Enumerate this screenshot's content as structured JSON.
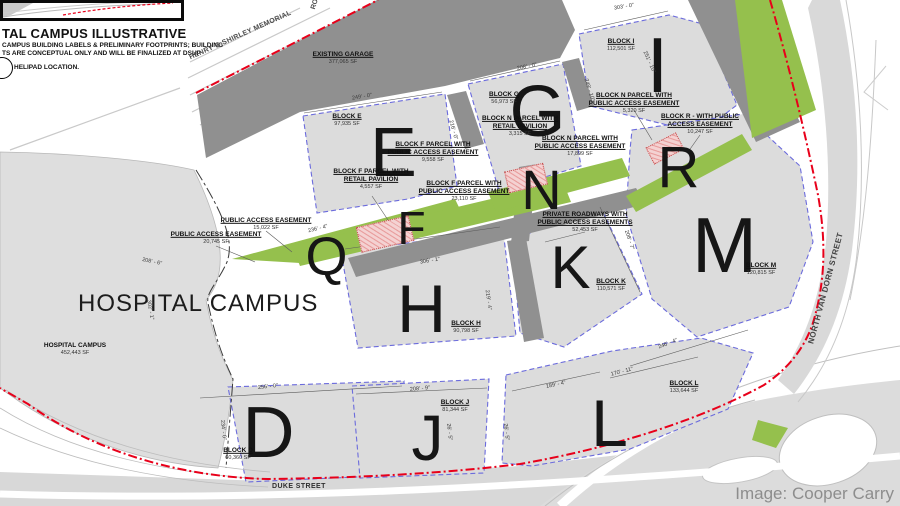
{
  "title_block": {
    "title": "TAL CAMPUS ILLUSTRATIVE",
    "note_line1": "CAMPUS BUILDING LABELS & PRELIMINARY FOOTPRINTS; BUILDING",
    "note_line2": "TS ARE CONCEPTUAL ONLY AND WILL BE FINALIZED AT DSUP",
    "helipad_label": "HELIPAD LOCATION."
  },
  "streets": {
    "duke": "DUKE STREET",
    "van_dorn": "NORTH VAN DORN STREET",
    "shirley": "HENRY G.SHIRLEY MEMORIAL",
    "road": "ROAD"
  },
  "campus": {
    "big_label": "HOSPITAL CAMPUS"
  },
  "credit": "Image: Cooper Carry",
  "letters": [
    {
      "ch": "E",
      "x": 393,
      "y": 152,
      "size": 70
    },
    {
      "ch": "F",
      "x": 411,
      "y": 228,
      "size": 46
    },
    {
      "ch": "G",
      "x": 537,
      "y": 112,
      "size": 72
    },
    {
      "ch": "N",
      "x": 541,
      "y": 190,
      "size": 56
    },
    {
      "ch": "I",
      "x": 657,
      "y": 65,
      "size": 78
    },
    {
      "ch": "R",
      "x": 678,
      "y": 168,
      "size": 58
    },
    {
      "ch": "M",
      "x": 724,
      "y": 245,
      "size": 78
    },
    {
      "ch": "Q",
      "x": 326,
      "y": 257,
      "size": 54
    },
    {
      "ch": "K",
      "x": 570,
      "y": 268,
      "size": 60
    },
    {
      "ch": "H",
      "x": 421,
      "y": 309,
      "size": 68
    },
    {
      "ch": "D",
      "x": 268,
      "y": 433,
      "size": 72
    },
    {
      "ch": "J",
      "x": 427,
      "y": 438,
      "size": 64
    },
    {
      "ch": "L",
      "x": 609,
      "y": 423,
      "size": 66
    }
  ],
  "parcel_labels": [
    {
      "lines": [
        "EXISTING GARAGE"
      ],
      "sf": "377,065 SF",
      "x": 343,
      "y": 58
    },
    {
      "lines": [
        "BLOCK E"
      ],
      "sf": "97,935 SF",
      "x": 347,
      "y": 120
    },
    {
      "lines": [
        "BLOCK G"
      ],
      "sf": "56,973 SF",
      "x": 504,
      "y": 98
    },
    {
      "lines": [
        "BLOCK I"
      ],
      "sf": "112,501 SF",
      "x": 621,
      "y": 45
    },
    {
      "lines": [
        "BLOCK N PARCEL WITH",
        "RETAIL PAVILION"
      ],
      "sf": "3,315 SF",
      "x": 520,
      "y": 126
    },
    {
      "lines": [
        "BLOCK N PARCEL WITH",
        "PUBLIC ACCESS EASEMENT"
      ],
      "sf": "17,899 SF",
      "x": 580,
      "y": 146
    },
    {
      "lines": [
        "BLOCK N PARCEL WITH",
        "PUBLIC ACCESS EASEMENT"
      ],
      "sf": "5,320 SF",
      "x": 634,
      "y": 103
    },
    {
      "lines": [
        "BLOCK R -  WITH PUBLIC",
        "ACCESS EASEMENT"
      ],
      "sf": "10,247 SF",
      "x": 700,
      "y": 124
    },
    {
      "lines": [
        "BLOCK F PARCEL WITH",
        "PUBLIC ACCESS EASEMENT"
      ],
      "sf": "9,558 SF",
      "x": 433,
      "y": 152
    },
    {
      "lines": [
        "BLOCK F PARCEL WITH",
        "RETAIL PAVILION"
      ],
      "sf": "4,557 SF",
      "x": 371,
      "y": 179
    },
    {
      "lines": [
        "BLOCK F PARCEL WITH",
        "PUBLIC ACCESS EASEMENT"
      ],
      "sf": "23,110 SF",
      "x": 464,
      "y": 191
    },
    {
      "lines": [
        "PUBLIC ACCESS EASEMENT"
      ],
      "sf": "15,022 SF",
      "x": 266,
      "y": 224
    },
    {
      "lines": [
        "PUBLIC ACCESS EASEMENT"
      ],
      "sf": "20,745 SF",
      "x": 216,
      "y": 238
    },
    {
      "lines": [
        "PRIVATE ROADWAYS WITH",
        "PUBLIC ACCESS EASEMENTS"
      ],
      "sf": "52,453 SF",
      "x": 585,
      "y": 222
    },
    {
      "lines": [
        "BLOCK K"
      ],
      "sf": "110,571 SF",
      "x": 611,
      "y": 285
    },
    {
      "lines": [
        "BLOCK M"
      ],
      "sf": "120,815 SF",
      "x": 761,
      "y": 269
    },
    {
      "lines": [
        "BLOCK H"
      ],
      "sf": "90,798 SF",
      "x": 466,
      "y": 327
    },
    {
      "lines": [
        "HOSPITAL CAMPUS"
      ],
      "sf": "452,443 SF",
      "x": 75,
      "y": 349,
      "plain": true
    },
    {
      "lines": [
        "BLOCK D"
      ],
      "sf": "60,360 SF",
      "x": 238,
      "y": 454
    },
    {
      "lines": [
        "BLOCK J"
      ],
      "sf": "81,344 SF",
      "x": 455,
      "y": 406
    },
    {
      "lines": [
        "BLOCK L"
      ],
      "sf": "133,644 SF",
      "x": 684,
      "y": 387
    }
  ],
  "dimensions": [
    {
      "text": "249' - 0\"",
      "x": 362,
      "y": 97,
      "rot": -9
    },
    {
      "text": "208' - 0\"",
      "x": 527,
      "y": 67,
      "rot": -11
    },
    {
      "text": "303' - 0\"",
      "x": 624,
      "y": 7,
      "rot": -9
    },
    {
      "text": "216' - 0\"",
      "x": 453,
      "y": 130,
      "rot": 75
    },
    {
      "text": "249' - 10\"",
      "x": 589,
      "y": 90,
      "rot": 72
    },
    {
      "text": "251' - 10\"",
      "x": 649,
      "y": 62,
      "rot": 66
    },
    {
      "text": "236' - 4\"",
      "x": 318,
      "y": 229,
      "rot": -14
    },
    {
      "text": "306' - 1\"",
      "x": 430,
      "y": 261,
      "rot": -9
    },
    {
      "text": "219' - 4\"",
      "x": 488,
      "y": 300,
      "rot": 82
    },
    {
      "text": "208' - 7\"",
      "x": 629,
      "y": 240,
      "rot": 72
    },
    {
      "text": "246' - 4\"",
      "x": 668,
      "y": 344,
      "rot": -21
    },
    {
      "text": "256' - 0\"",
      "x": 268,
      "y": 387,
      "rot": -6
    },
    {
      "text": "234' - 0\"",
      "x": 223,
      "y": 430,
      "rot": 84
    },
    {
      "text": "208' - 9\"",
      "x": 420,
      "y": 389,
      "rot": -5
    },
    {
      "text": "189' - 4\"",
      "x": 556,
      "y": 385,
      "rot": -12
    },
    {
      "text": "170' - 11\"",
      "x": 622,
      "y": 372,
      "rot": -14
    },
    {
      "text": "302' - 1\"",
      "x": 150,
      "y": 310,
      "rot": 80
    },
    {
      "text": "208' - 6\"",
      "x": 152,
      "y": 262,
      "rot": 12
    },
    {
      "text": "26' - 5\"",
      "x": 449,
      "y": 432,
      "rot": 83
    },
    {
      "text": "26' - 5\"",
      "x": 506,
      "y": 432,
      "rot": 83
    }
  ],
  "colors": {
    "block_fill": "#dcdcdc",
    "garage_fill": "#909090",
    "green_easement": "#95c04d",
    "pink_pavilion": "#f2cfcf",
    "red_property_line": "#e8001a",
    "blue_parcel_dash": "#6b6bdc",
    "road_gray": "#d8d8d8",
    "credit_gray": "#8d8d8d"
  }
}
